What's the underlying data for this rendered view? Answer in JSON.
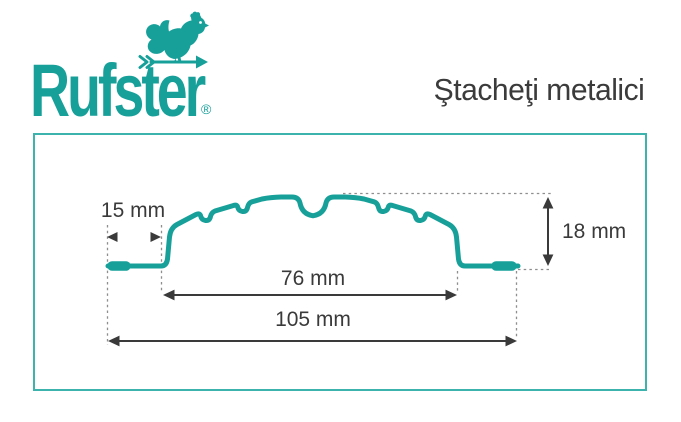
{
  "logo": {
    "brand": "Rufster",
    "registered": "®",
    "icon": "rooster-weathervane-icon",
    "color": "#17a09a"
  },
  "header": {
    "title": "Ştacheţi metalici"
  },
  "diagram": {
    "dimensions": {
      "edge_width": "15 mm",
      "profile_height": "18 mm",
      "crown_width": "76 mm",
      "total_width": "105 mm"
    },
    "colors": {
      "profile": "#17a09a",
      "frame_border": "#3cb3ac",
      "dimension_lines": "#3a3a3a",
      "guide_lines": "#8e8e8e"
    }
  }
}
